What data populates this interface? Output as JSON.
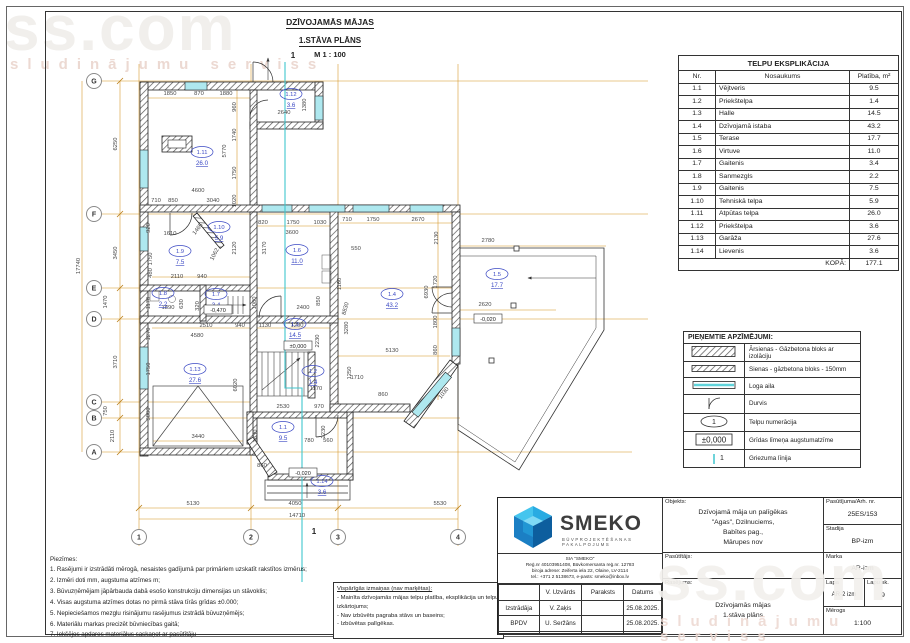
{
  "sheet_title": {
    "line1": "DZĪVOJAMĀS MĀJAS",
    "line2": "1.STĀVA PLĀNS",
    "line3": "M 1 : 100"
  },
  "watermark": {
    "text": "ss.com",
    "subtext": "sludinājumu serviss"
  },
  "colors": {
    "dim_line": "#d4921e",
    "room_label": "#3b49c4",
    "section_line": "#3fc6cd",
    "window_fill": "#aee8ef",
    "wall": "#222222",
    "dim_text": "#474747"
  },
  "explication": {
    "title": "TELPU EKSPLIKĀCIJA",
    "columns": [
      "Nr.",
      "Nosaukums",
      "Platība, m²"
    ],
    "rows": [
      [
        "1.1",
        "Vējtveris",
        "9.5"
      ],
      [
        "1.2",
        "Priekštelpa",
        "1.4"
      ],
      [
        "1.3",
        "Halle",
        "14.5"
      ],
      [
        "1.4",
        "Dzīvojamā istaba",
        "43.2"
      ],
      [
        "1.5",
        "Terase",
        "17.7"
      ],
      [
        "1.6",
        "Virtuve",
        "11.0"
      ],
      [
        "1.7",
        "Gaitenis",
        "3.4"
      ],
      [
        "1.8",
        "Sanmezgls",
        "2.2"
      ],
      [
        "1.9",
        "Gaitenis",
        "7.5"
      ],
      [
        "1.10",
        "Tehniskā telpa",
        "5.9"
      ],
      [
        "1.11",
        "Atpūtas telpa",
        "26.0"
      ],
      [
        "1.12",
        "Priekštelpa",
        "3.6"
      ],
      [
        "1.13",
        "Garāža",
        "27.6"
      ],
      [
        "1.14",
        "Lievenis",
        "3.6"
      ]
    ],
    "total_label": "KOPĀ:",
    "total_value": "177.1"
  },
  "legend": {
    "title": "PIEŅEMTIE APZĪMĒJUMI:",
    "items": [
      {
        "symbol": "wall-exterior",
        "label": "Ārsienas - Gāzbetona bloks ar izolāciju"
      },
      {
        "symbol": "wall-interior",
        "label": "Sienas - gāzbetona bloks - 150mm"
      },
      {
        "symbol": "window",
        "label": "Loga aila"
      },
      {
        "symbol": "door",
        "label": "Durvis"
      },
      {
        "symbol": "room-number",
        "label": "Telpu numerācija",
        "sample": "1"
      },
      {
        "symbol": "level-mark",
        "label": "Grīdas līmeņa augstumatzīme",
        "sample": "±0,000"
      },
      {
        "symbol": "section-line",
        "label": "Griezuma līnija",
        "sample": "1"
      }
    ]
  },
  "notes": {
    "title": "Piezīmes:",
    "items": [
      "1. Rasējumi ir izstrādāti mērogā, nesaistes gadījumā par primāriem uzskatīt rakstītos izmērus;",
      "2. Izmēri doti mm, augstuma atzīmes m;",
      "3. Būvuzņēmējam jāpārbauda dabā esošo konstrukciju dimensijas un stāvoklis;",
      "4. Visas augstuma atzīmes dotas no pirmā stāva tīrās grīdas ±0.000;",
      "5. Nepieciešamos mezglu risinājumu rasējumus izstrādā būvuzņēmējs;",
      "6. Materiālu markas precizēt būvniecības gaitā;",
      "7. Iekšējos apdares materiālus saskaņot ar pasūtītāju"
    ]
  },
  "changes": {
    "title": "Vispārīgās izmaiņas (nav marķētas):",
    "items": [
      "- Mainīta dzīvojamās mājas telpu platība, eksplikācija un telpu izkārtojums;",
      "- Nav izbūvēts pagraba stāvs un baseins;",
      "- Izbūvētas palīgēkas."
    ]
  },
  "titleblock": {
    "logo_text": "SMEKO",
    "logo_sub": "BŪVPROJEKTĒŠANAS PAKALPOJUMS",
    "company_lines": [
      "SIA \"SMEKO\"",
      "Reģ.nr 40103951408, Būvkomersanta reģ.nr. 12783",
      "biroja adrese: Zeiferta iela 22, Olaine, LV-2114",
      "tel.: +371 2 5138673, e-pasts: smeko@inbox.lv"
    ],
    "sign_table": {
      "headers": [
        "",
        "V. Uzvārds",
        "Paraksts",
        "Datums"
      ],
      "rows": [
        [
          "Izstrādāja",
          "V. Zaķis",
          "",
          "25.08.2025."
        ],
        [
          "BPDV",
          "U. Seržāns",
          "",
          "25.08.2025."
        ],
        [
          "",
          "",
          "",
          ""
        ]
      ]
    },
    "objekts_label": "Objekts:",
    "objekts_value": [
      "Dzīvojamā māja un palīgēkas",
      "\"Agas\", Dzilnuciems,",
      "Babītes pag.,",
      "Mārupes nov"
    ],
    "pasutitajs_label": "Pasūtītājs:",
    "rasejums_label": "Rasējums:",
    "rasejums_value": [
      "Dzīvojamās mājas",
      "1.stāva plāns"
    ],
    "pasutijuma_label": "Pasūtījuma/Arh. nr.",
    "pasutijuma_value": "25ES/153",
    "stadija_label": "Stadija",
    "stadija_value": "BP-izm",
    "marka_label": "Marka",
    "marka_value": "AR-izm",
    "lapa_label": "Lapa",
    "lapa_value": "AR-2 izm",
    "lapu_sk_label": "Lapu sk.",
    "lapu_sk_value": "9",
    "merogs_label": "Mērogs",
    "merogs_value": "1:100"
  },
  "plan": {
    "grid_rows": [
      {
        "label": "G",
        "y": 81
      },
      {
        "label": "F",
        "y": 214
      },
      {
        "label": "E",
        "y": 288
      },
      {
        "label": "D",
        "y": 319
      },
      {
        "label": "C",
        "y": 402
      },
      {
        "label": "B",
        "y": 418
      },
      {
        "label": "A",
        "y": 452
      }
    ],
    "grid_cols": [
      {
        "label": "1",
        "x": 139
      },
      {
        "label": "2",
        "x": 251
      },
      {
        "label": "3",
        "x": 338
      },
      {
        "label": "4",
        "x": 458
      }
    ],
    "section_markers": [
      {
        "t": "1",
        "x": 293,
        "y": 58
      },
      {
        "t": "1",
        "x": 314,
        "y": 534
      }
    ],
    "rooms": [
      {
        "id": "1.11",
        "area": "26.0",
        "x": 202,
        "y": 152
      },
      {
        "id": "1.12",
        "area": "3.6",
        "x": 291,
        "y": 94
      },
      {
        "id": "1.10",
        "area": "5.9",
        "x": 219,
        "y": 227
      },
      {
        "id": "1.9",
        "area": "7.5",
        "x": 180,
        "y": 251
      },
      {
        "id": "1.6",
        "area": "11.0",
        "x": 297,
        "y": 250
      },
      {
        "id": "1.4",
        "area": "43.2",
        "x": 392,
        "y": 294
      },
      {
        "id": "1.5",
        "area": "17.7",
        "x": 497,
        "y": 274
      },
      {
        "id": "1.8",
        "area": "2.2",
        "x": 163,
        "y": 293
      },
      {
        "id": "1.7",
        "area": "3.4",
        "x": 216,
        "y": 294
      },
      {
        "id": "1.3",
        "area": "14.5",
        "x": 295,
        "y": 324
      },
      {
        "id": "1.2",
        "area": "1.4",
        "x": 313,
        "y": 371
      },
      {
        "id": "1.13",
        "area": "27.6",
        "x": 195,
        "y": 369
      },
      {
        "id": "1.1",
        "area": "9.5",
        "x": 283,
        "y": 427
      },
      {
        "id": "1.14",
        "area": "3.6",
        "x": 322,
        "y": 481
      }
    ],
    "levels": [
      {
        "t": "±0,000",
        "x": 298,
        "y": 347
      },
      {
        "t": "-0,470",
        "x": 218,
        "y": 311
      },
      {
        "t": "-0,020",
        "x": 303,
        "y": 474
      },
      {
        "t": "-0,020",
        "x": 488,
        "y": 320
      }
    ],
    "dims": [
      {
        "t": "1850",
        "x": 170,
        "y": 95
      },
      {
        "t": "870",
        "x": 199,
        "y": 95
      },
      {
        "t": "1880",
        "x": 226,
        "y": 95
      },
      {
        "t": "960",
        "x": 236,
        "y": 107,
        "r": -90
      },
      {
        "t": "2640",
        "x": 284,
        "y": 114
      },
      {
        "t": "1380",
        "x": 306,
        "y": 105,
        "r": -90
      },
      {
        "t": "1740",
        "x": 236,
        "y": 135,
        "r": -90
      },
      {
        "t": "5770",
        "x": 226,
        "y": 151,
        "r": -90
      },
      {
        "t": "1750",
        "x": 236,
        "y": 173,
        "r": -90
      },
      {
        "t": "1020",
        "x": 236,
        "y": 201,
        "r": -90
      },
      {
        "t": "4600",
        "x": 198,
        "y": 192
      },
      {
        "t": "710",
        "x": 156,
        "y": 202
      },
      {
        "t": "850",
        "x": 173,
        "y": 202
      },
      {
        "t": "3040",
        "x": 213,
        "y": 202
      },
      {
        "t": "6250",
        "x": 117,
        "y": 144,
        "r": -90
      },
      {
        "t": "3450",
        "x": 117,
        "y": 253,
        "r": -90
      },
      {
        "t": "17740",
        "x": 80,
        "y": 266,
        "r": -90
      },
      {
        "t": "1470",
        "x": 107,
        "y": 302,
        "r": -90
      },
      {
        "t": "3710",
        "x": 117,
        "y": 362,
        "r": -90
      },
      {
        "t": "750",
        "x": 107,
        "y": 411,
        "r": -90
      },
      {
        "t": "2110",
        "x": 114,
        "y": 436,
        "r": -90
      },
      {
        "t": "920",
        "x": 150,
        "y": 228,
        "r": -90
      },
      {
        "t": "1610",
        "x": 170,
        "y": 235
      },
      {
        "t": "1465",
        "x": 199,
        "y": 230,
        "r": -52
      },
      {
        "t": "1062",
        "x": 216,
        "y": 255,
        "r": -62
      },
      {
        "t": "2120",
        "x": 236,
        "y": 248,
        "r": -90
      },
      {
        "t": "3170",
        "x": 266,
        "y": 248,
        "r": -90
      },
      {
        "t": "820",
        "x": 263,
        "y": 224
      },
      {
        "t": "1750",
        "x": 293,
        "y": 224
      },
      {
        "t": "1030",
        "x": 320,
        "y": 224
      },
      {
        "t": "3600",
        "x": 292,
        "y": 234
      },
      {
        "t": "1750",
        "x": 152,
        "y": 259,
        "r": -90
      },
      {
        "t": "480",
        "x": 152,
        "y": 273,
        "r": -90
      },
      {
        "t": "2110",
        "x": 177,
        "y": 278
      },
      {
        "t": "940",
        "x": 202,
        "y": 278
      },
      {
        "t": "710",
        "x": 347,
        "y": 221
      },
      {
        "t": "1750",
        "x": 373,
        "y": 221
      },
      {
        "t": "2670",
        "x": 418,
        "y": 221
      },
      {
        "t": "2130",
        "x": 438,
        "y": 238,
        "r": -90
      },
      {
        "t": "550",
        "x": 356,
        "y": 250
      },
      {
        "t": "1160",
        "x": 341,
        "y": 284,
        "r": -90
      },
      {
        "t": "8830",
        "x": 347,
        "y": 309,
        "r": -75
      },
      {
        "t": "6930",
        "x": 428,
        "y": 292,
        "r": -90
      },
      {
        "t": "1720",
        "x": 437,
        "y": 282,
        "r": -90
      },
      {
        "t": "1800",
        "x": 437,
        "y": 322,
        "r": -90
      },
      {
        "t": "860",
        "x": 437,
        "y": 350,
        "r": -90
      },
      {
        "t": "5130",
        "x": 392,
        "y": 352
      },
      {
        "t": "1710",
        "x": 357,
        "y": 379
      },
      {
        "t": "860",
        "x": 383,
        "y": 396
      },
      {
        "t": "1030",
        "x": 445,
        "y": 394,
        "r": -52
      },
      {
        "t": "2780",
        "x": 488,
        "y": 242
      },
      {
        "t": "2620",
        "x": 485,
        "y": 306
      },
      {
        "t": "1170",
        "x": 150,
        "y": 303,
        "r": -90
      },
      {
        "t": "1890",
        "x": 168,
        "y": 309
      },
      {
        "t": "630",
        "x": 183,
        "y": 304,
        "r": -90
      },
      {
        "t": "320",
        "x": 199,
        "y": 306,
        "r": -90
      },
      {
        "t": "1080",
        "x": 256,
        "y": 303,
        "r": -90
      },
      {
        "t": "2400",
        "x": 303,
        "y": 309
      },
      {
        "t": "850",
        "x": 320,
        "y": 301,
        "r": -90
      },
      {
        "t": "3280",
        "x": 348,
        "y": 328,
        "r": -90
      },
      {
        "t": "2230",
        "x": 319,
        "y": 341,
        "r": -90
      },
      {
        "t": "2510",
        "x": 206,
        "y": 327
      },
      {
        "t": "940",
        "x": 240,
        "y": 327
      },
      {
        "t": "1130",
        "x": 265,
        "y": 327
      },
      {
        "t": "1200",
        "x": 297,
        "y": 327
      },
      {
        "t": "4580",
        "x": 197,
        "y": 337
      },
      {
        "t": "1270",
        "x": 150,
        "y": 334,
        "r": -90
      },
      {
        "t": "1750",
        "x": 150,
        "y": 369,
        "r": -90
      },
      {
        "t": "3000",
        "x": 150,
        "y": 414,
        "r": -90
      },
      {
        "t": "6020",
        "x": 237,
        "y": 385,
        "r": -90
      },
      {
        "t": "3440",
        "x": 198,
        "y": 438
      },
      {
        "t": "1250",
        "x": 351,
        "y": 373,
        "r": -90
      },
      {
        "t": "1170",
        "x": 316,
        "y": 390
      },
      {
        "t": "2530",
        "x": 283,
        "y": 408
      },
      {
        "t": "970",
        "x": 319,
        "y": 408
      },
      {
        "t": "3330",
        "x": 257,
        "y": 436,
        "r": -90
      },
      {
        "t": "2230",
        "x": 325,
        "y": 432,
        "r": -90
      },
      {
        "t": "780",
        "x": 309,
        "y": 442
      },
      {
        "t": "560",
        "x": 328,
        "y": 442
      },
      {
        "t": "860",
        "x": 262,
        "y": 467
      },
      {
        "t": "5130",
        "x": 193,
        "y": 505
      },
      {
        "t": "4050",
        "x": 295,
        "y": 505
      },
      {
        "t": "5530",
        "x": 440,
        "y": 505
      },
      {
        "t": "14710",
        "x": 297,
        "y": 517
      }
    ]
  }
}
